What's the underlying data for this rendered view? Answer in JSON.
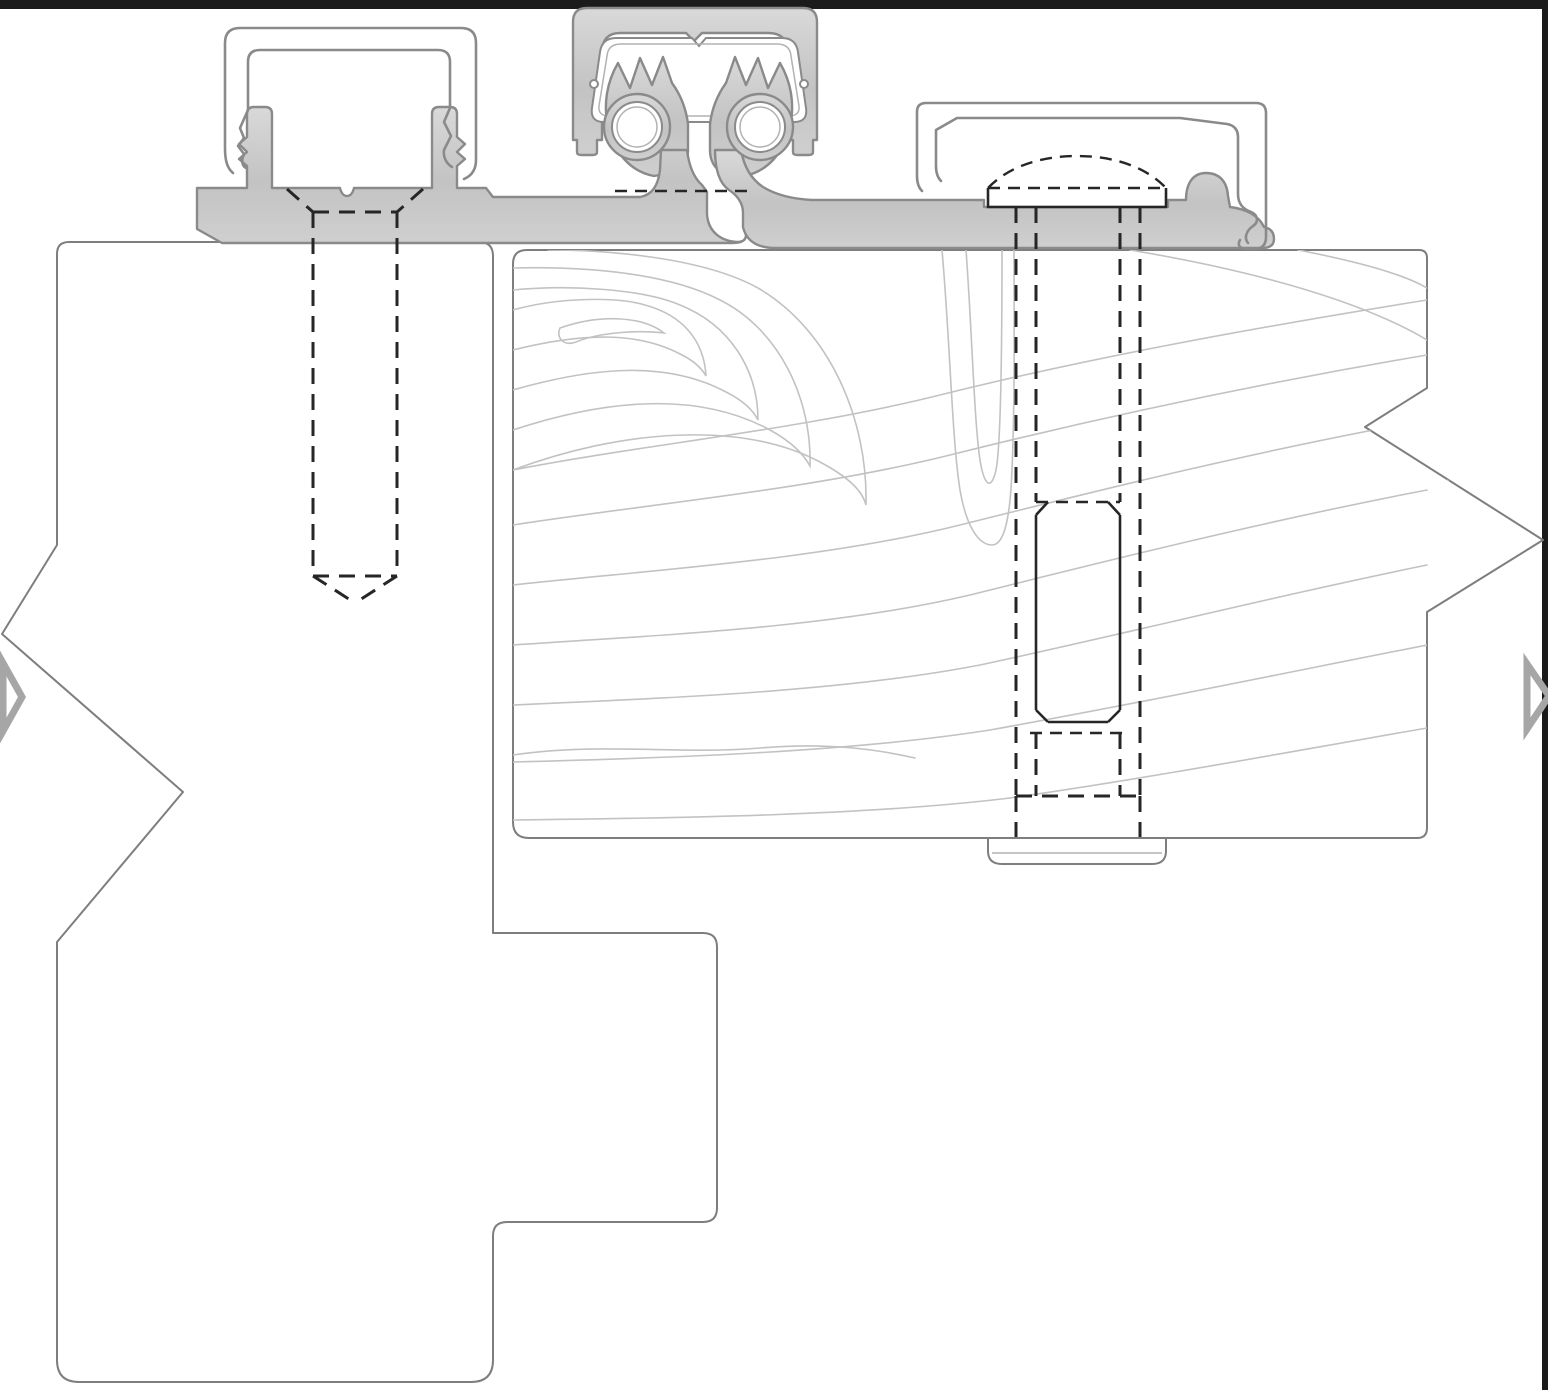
{
  "meta": {
    "drawing_kind": "CAD cross-section detail",
    "subject": "continuous geared hinge joining a door frame jamb and a wood door edge",
    "canvas": {
      "width": 1548,
      "height": 1390
    },
    "visible_text": []
  },
  "palette": {
    "background": "#ffffff",
    "border_bar": "#1b1b1b",
    "profile_line": "#7e7e7e",
    "grain_line": "#c2c2c2",
    "metal_fill_top": "#d9d9d9",
    "metal_fill_mid": "#c3c3c3",
    "metal_fill_bot": "#cfcfcf",
    "metal_stroke": "#8a8a8a",
    "metal_inner_line": "#b2b2b2",
    "dash_line": "#262626",
    "marker": "#a6a6a6",
    "dash_pattern": "16 10",
    "dash_pattern_fine": "12 8"
  },
  "components": {
    "page_border": {
      "top_bar": "black strip along top edge",
      "right_bar": "black strip along right edge"
    },
    "frame_jamb": {
      "kind": "frame jamb profile outline",
      "break_symbol": "zigzag break on left side"
    },
    "door_panel": {
      "kind": "wood door section with grain lines",
      "break_symbol": "zigzag break on right side"
    },
    "hinge": {
      "gear_cap": "extruded cap channel over meshing gear leaves",
      "frame_leaf": "hinge leaf fastened to frame with barbed retainer posts",
      "door_leaf": "hinge leaf fastened to door with dome-head bolt pocket",
      "gears": "two meshing gear knuckles with pin bores"
    },
    "fasteners": {
      "frame_screw": {
        "representation": "hidden lines (dashed)",
        "head": "countersunk flat head",
        "tip": "pointed"
      },
      "door_bolt": {
        "representation": "hidden lines (dashed)",
        "head": "dome head",
        "nut": "chamfered barrel nut",
        "base": "flat cap visible on far face"
      }
    },
    "markers": {
      "left": "gray break arrowhead at left edge",
      "right": "gray break arrowhead at right edge"
    }
  }
}
